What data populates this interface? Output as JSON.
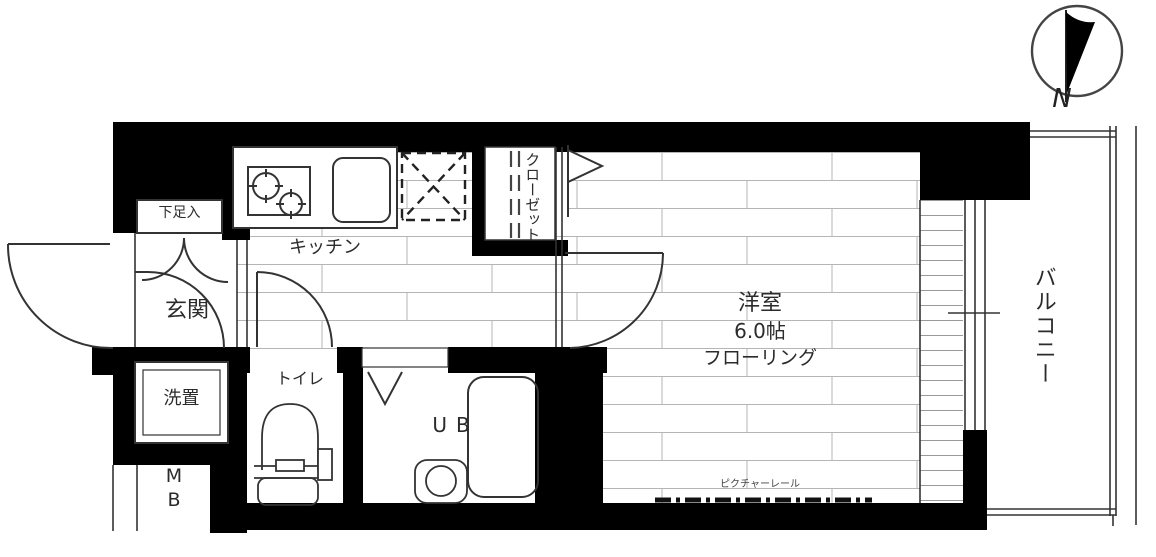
{
  "plan": {
    "compass": {
      "label": "N"
    },
    "rooms": {
      "entrance": "玄関",
      "shoe_cabinet": "下足入",
      "kitchen": "キッチン",
      "closet": "クローゼット",
      "western_room_name": "洋室",
      "western_room_size": "6.0帖",
      "western_room_floor": "フローリング",
      "toilet": "トイレ",
      "washer": "洗置",
      "unit_bath": "UB",
      "meter_box_line1": "M",
      "meter_box_line2": "B",
      "balcony": "バルコニー",
      "picture_rail": "ピクチャーレール"
    },
    "colors": {
      "wall": "#000000",
      "outline": "#333333",
      "floor_grid": "#b5b5b5"
    }
  }
}
